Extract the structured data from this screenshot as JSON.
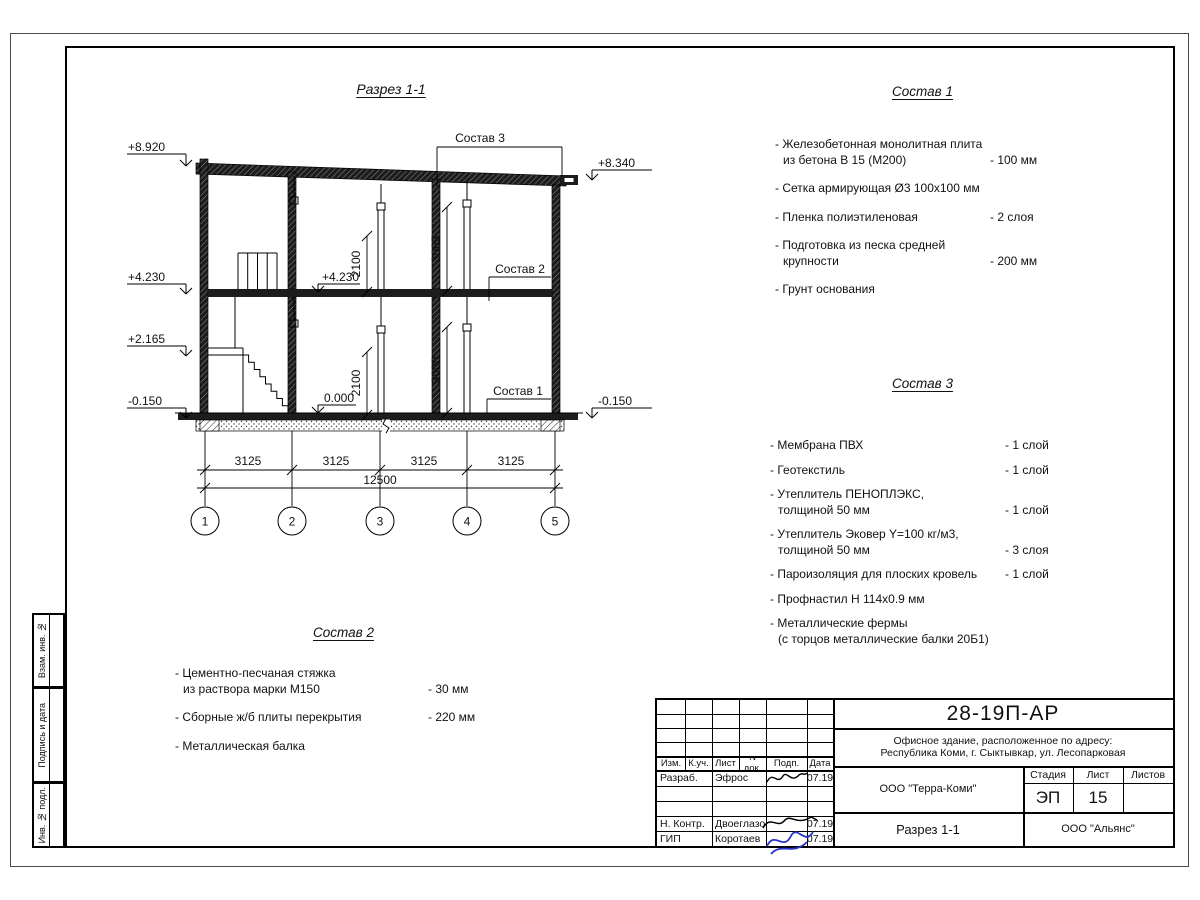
{
  "section": {
    "title": "Разрез 1-1",
    "callout_1": "Состав 1",
    "callout_2": "Состав 2",
    "callout_3": "Состав 3",
    "levels": {
      "roof_left": "+8.920",
      "floor2_left": "+4.230",
      "stair_left": "+2.165",
      "base_left": "-0.150",
      "roof_right": "+8.340",
      "base_right": "-0.150",
      "floor2_inner": "+4.230",
      "zero_inner": "0.000"
    },
    "dims": {
      "floor2_clear": "2100",
      "floor1_clear": "2100",
      "floor2_height": "3065",
      "floor1_height": "3000",
      "bay": "3125",
      "total": "12500"
    },
    "axes": [
      "1",
      "2",
      "3",
      "4",
      "5"
    ]
  },
  "sostav1": {
    "title": "Состав 1",
    "items": [
      {
        "l1": "- Железобетонная  монолитная плита",
        "l2": "из бетона В 15 (М200)",
        "qty": "- 100 мм"
      },
      {
        "l1": "- Сетка армирующая Ø3 100х100 мм",
        "l2": "",
        "qty": ""
      },
      {
        "l1": "- Пленка полиэтиленовая",
        "l2": "",
        "qty": "-  2 слоя"
      },
      {
        "l1": "- Подготовка из песка средней",
        "l2": "крупности",
        "qty": "- 200 мм"
      },
      {
        "l1": "- Грунт основания",
        "l2": "",
        "qty": ""
      }
    ]
  },
  "sostav2": {
    "title": "Состав 2",
    "items": [
      {
        "l1": "- Цементно-песчаная стяжка",
        "l2": "из раствора марки М150",
        "qty": "- 30 мм"
      },
      {
        "l1": "- Сборные ж/б плиты перекрытия",
        "l2": "",
        "qty": "- 220 мм"
      },
      {
        "l1": "- Металлическая балка",
        "l2": "",
        "qty": ""
      }
    ]
  },
  "sostav3": {
    "title": "Состав 3",
    "items": [
      {
        "l1": "- Мембрана ПВХ",
        "l2": "",
        "qty": "- 1 слой"
      },
      {
        "l1": "- Геотекстиль",
        "l2": "",
        "qty": "- 1 слой"
      },
      {
        "l1": "- Утеплитель ПЕНОПЛЭКС,",
        "l2": "толщиной 50 мм",
        "qty": "- 1 слой"
      },
      {
        "l1": "- Утеплитель Эковер Y=100 кг/м3,",
        "l2": "толщиной 50 мм",
        "qty": "- 3 слоя"
      },
      {
        "l1": "- Пароизоляция для плоских кровель",
        "l2": "",
        "qty": "- 1 слой"
      },
      {
        "l1": "- Профнастил Н 114х0.9 мм",
        "l2": "",
        "qty": ""
      },
      {
        "l1": "- Металлические фермы",
        "l2": "(с торцов металлические балки 20Б1)",
        "qty": ""
      }
    ]
  },
  "titleblock": {
    "doc_number": "28-19П-АР",
    "project_line1": "Офисное здание, расположенное по адресу:",
    "project_line2": "Республика Коми, г. Сыктывкар, ул. Лесопарковая",
    "org": "ООО \"Терра-Коми\"",
    "sheet_title": "Разрез 1-1",
    "contractor": "ООО \"Альянс\"",
    "stage_label": "Стадия",
    "sheet_label": "Лист",
    "sheets_label": "Листов",
    "stage": "ЭП",
    "sheet_no": "15",
    "sheets_total": "",
    "cols": {
      "izm": "Изм.",
      "kuch": "К.уч.",
      "list": "Лист",
      "ndok": "N док.",
      "podp": "Подп.",
      "data": "Дата"
    },
    "rows": [
      {
        "role": "Разраб.",
        "name": "Эфрос",
        "date": "07.19"
      },
      {
        "role": "Н. Контр.",
        "name": "Двоеглазов",
        "date": "07.19"
      },
      {
        "role": "ГИП",
        "name": "Коротаев",
        "date": "07.19"
      }
    ]
  },
  "margin_labels": {
    "top": "Взам. инв. №",
    "middle": "Подпись и дата",
    "bottom": "Инв. № подл."
  }
}
